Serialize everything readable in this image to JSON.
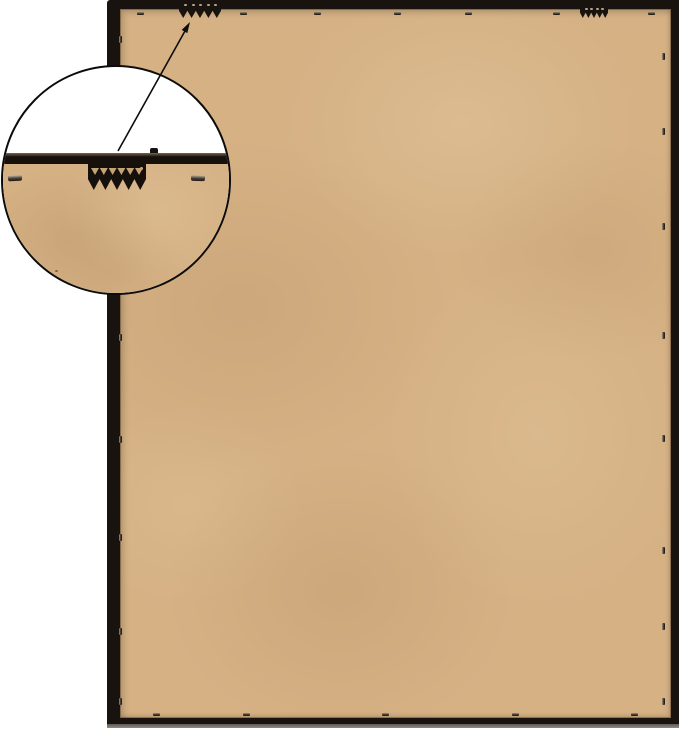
{
  "scene": {
    "kind": "product-photo",
    "subject": "Back view of a black picture frame with tan MDF backing board",
    "features": [
      "two sawtooth hangers attached to the top rail",
      "metal retainer points securing the backing board around all four edges",
      "circular magnifier callout showing sawtooth hanger detail",
      "annotation arrow from magnified detail to actual hanger"
    ]
  },
  "palette": {
    "background": "#ffffff",
    "frame-black": "#191310",
    "board-tan": "#d5b184",
    "metal-light": "#a29275",
    "metal-dark": "#27201a",
    "bottom-edge-gray": "#8f8b87",
    "arrow-black": "#0d0d0d",
    "callout-border": "#0c0c0c",
    "callout-bg": "#ffffff"
  },
  "frame": {
    "x": 107,
    "y": 0,
    "w": 572,
    "h": 726,
    "border_left": 13,
    "border_top": 9,
    "border_right": 8,
    "border_bottom": 8
  },
  "bottom_sheen": {
    "x": 107,
    "y": 724,
    "w": 572,
    "h": 4
  },
  "hangers": [
    {
      "name": "left-sawtooth-hanger",
      "x": 179,
      "y": 2,
      "w": 42,
      "h": 16,
      "dots": 5
    },
    {
      "name": "right-sawtooth-hanger",
      "x": 580,
      "y": 6,
      "w": 28,
      "h": 12,
      "dots": 4
    }
  ],
  "staples": {
    "top": {
      "y": 12,
      "x": [
        137,
        240,
        314,
        394,
        465,
        553,
        648
      ]
    },
    "bottom": {
      "y": 713,
      "x": [
        153,
        243,
        382,
        512,
        631
      ]
    },
    "left": {
      "x": 119,
      "y": [
        36,
        334,
        436,
        534,
        628,
        698
      ]
    },
    "right": {
      "x": 662,
      "y": [
        53,
        128,
        223,
        332,
        435,
        547,
        623,
        698
      ]
    }
  },
  "callout": {
    "x": 1,
    "y": 65,
    "d": 230,
    "magnified_bar": {
      "top": 86,
      "h": 11
    },
    "magnified_hanger": {
      "x": 85,
      "y": 97,
      "w": 58,
      "h": 26,
      "scallops": 6
    },
    "magnified_staples": [
      {
        "x": 5,
        "y": 108
      },
      {
        "x": 188,
        "y": 108
      }
    ],
    "board_specks": [
      {
        "x": 52,
        "y": 203
      },
      {
        "x": 67,
        "y": 221
      }
    ],
    "arrow": {
      "x1": 118,
      "y1": 151,
      "x2": 185,
      "y2": 31,
      "head_points": "190,22 187.3,33.1 181.7,29.9"
    }
  }
}
